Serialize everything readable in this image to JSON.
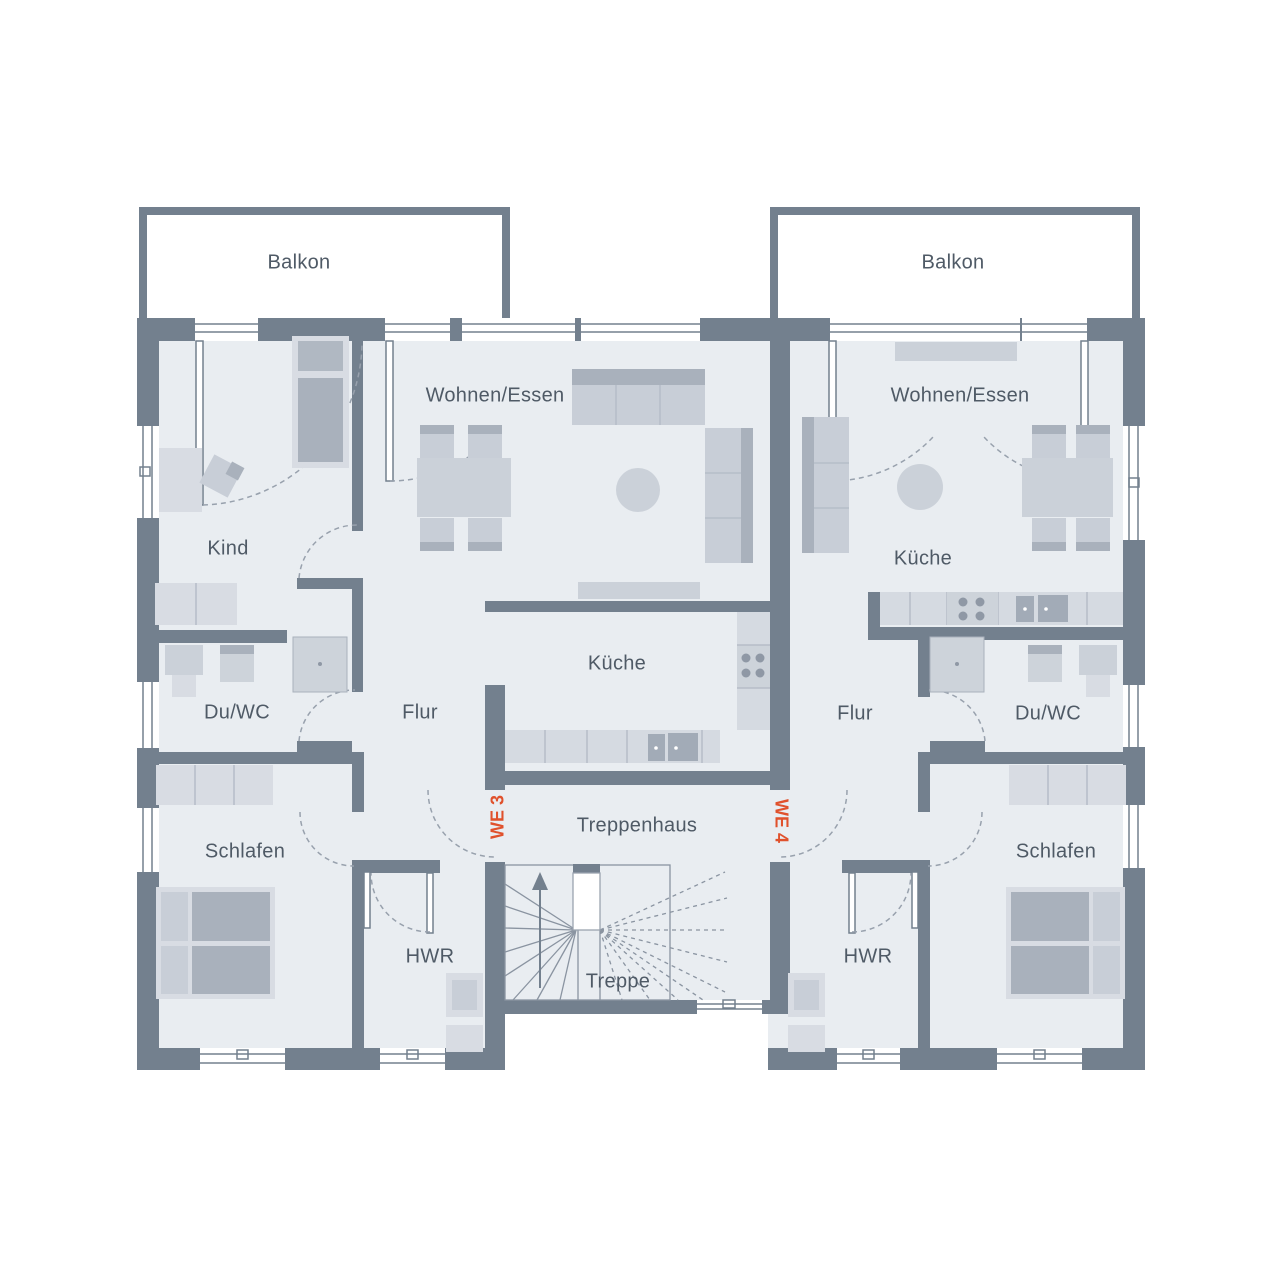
{
  "plan_type": "floor-plan",
  "colors": {
    "wall": "#73808E",
    "floor": "#E9EDF1",
    "furniture_light": "#D8DCE3",
    "furniture_dark": "#A9B1BC",
    "label_text": "#4F5A66",
    "unit_accent": "#E0512C",
    "background": "#FFFFFF"
  },
  "apartment_left": {
    "unit_label": "WE 3",
    "rooms": {
      "balkon": "Balkon",
      "wohnen_essen": "Wohnen/Essen",
      "kind": "Kind",
      "kueche": "Küche",
      "du_wc": "Du/WC",
      "flur": "Flur",
      "schlafen": "Schlafen",
      "hwr": "HWR"
    }
  },
  "apartment_right": {
    "unit_label": "WE 4",
    "rooms": {
      "balkon": "Balkon",
      "wohnen_essen": "Wohnen/Essen",
      "kueche": "Küche",
      "du_wc": "Du/WC",
      "flur": "Flur",
      "schlafen": "Schlafen",
      "hwr": "HWR"
    }
  },
  "stairwell": {
    "treppenhaus": "Treppenhaus",
    "treppe": "Treppe"
  }
}
